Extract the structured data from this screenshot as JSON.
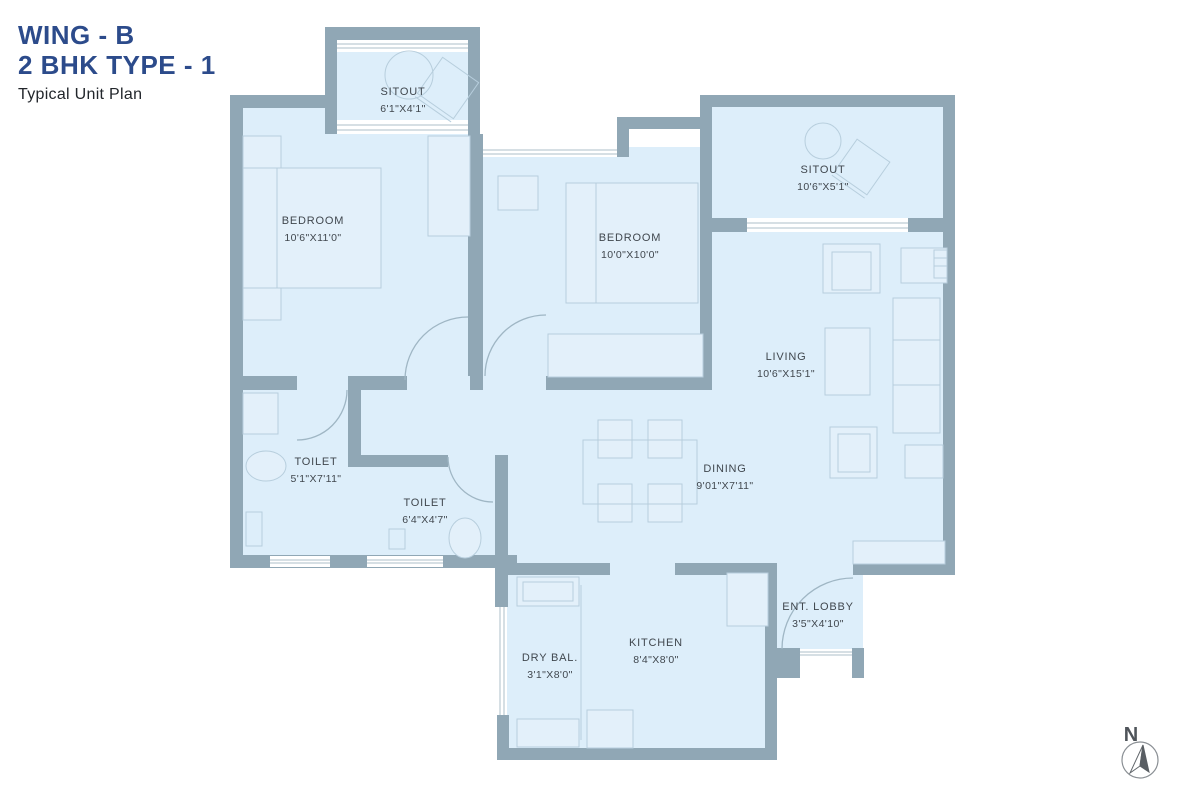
{
  "title": {
    "line1": "WING - B",
    "line2": "2 BHK TYPE - 1",
    "subtitle": "Typical Unit Plan"
  },
  "rooms": {
    "sitout_top": {
      "name": "SITOUT",
      "dims": "6'1\"X4'1\""
    },
    "bedroom_left": {
      "name": "BEDROOM",
      "dims": "10'6\"X11'0\""
    },
    "bedroom_mid": {
      "name": "BEDROOM",
      "dims": "10'0\"X10'0\""
    },
    "sitout_right": {
      "name": "SITOUT",
      "dims": "10'6\"X5'1\""
    },
    "living": {
      "name": "LIVING",
      "dims": "10'6\"X15'1\""
    },
    "dining": {
      "name": "DINING",
      "dims": "9'01\"X7'11\""
    },
    "toilet_left": {
      "name": "TOILET",
      "dims": "5'1\"X7'11\""
    },
    "toilet_mid": {
      "name": "TOILET",
      "dims": "6'4\"X4'7\""
    },
    "kitchen": {
      "name": "KITCHEN",
      "dims": "8'4\"X8'0\""
    },
    "dry_balcony": {
      "name": "DRY BAL.",
      "dims": "3'1\"X8'0\""
    },
    "ent_lobby": {
      "name": "ENT. LOBBY",
      "dims": "3'5\"X4'10\""
    }
  },
  "compass": {
    "label": "N"
  },
  "colors": {
    "wall": "#90a7b5",
    "floor": "#ddeefa",
    "title_accent": "#2c4b8b",
    "furniture_stroke": "#b7cedd",
    "label_text": "#40474e"
  }
}
